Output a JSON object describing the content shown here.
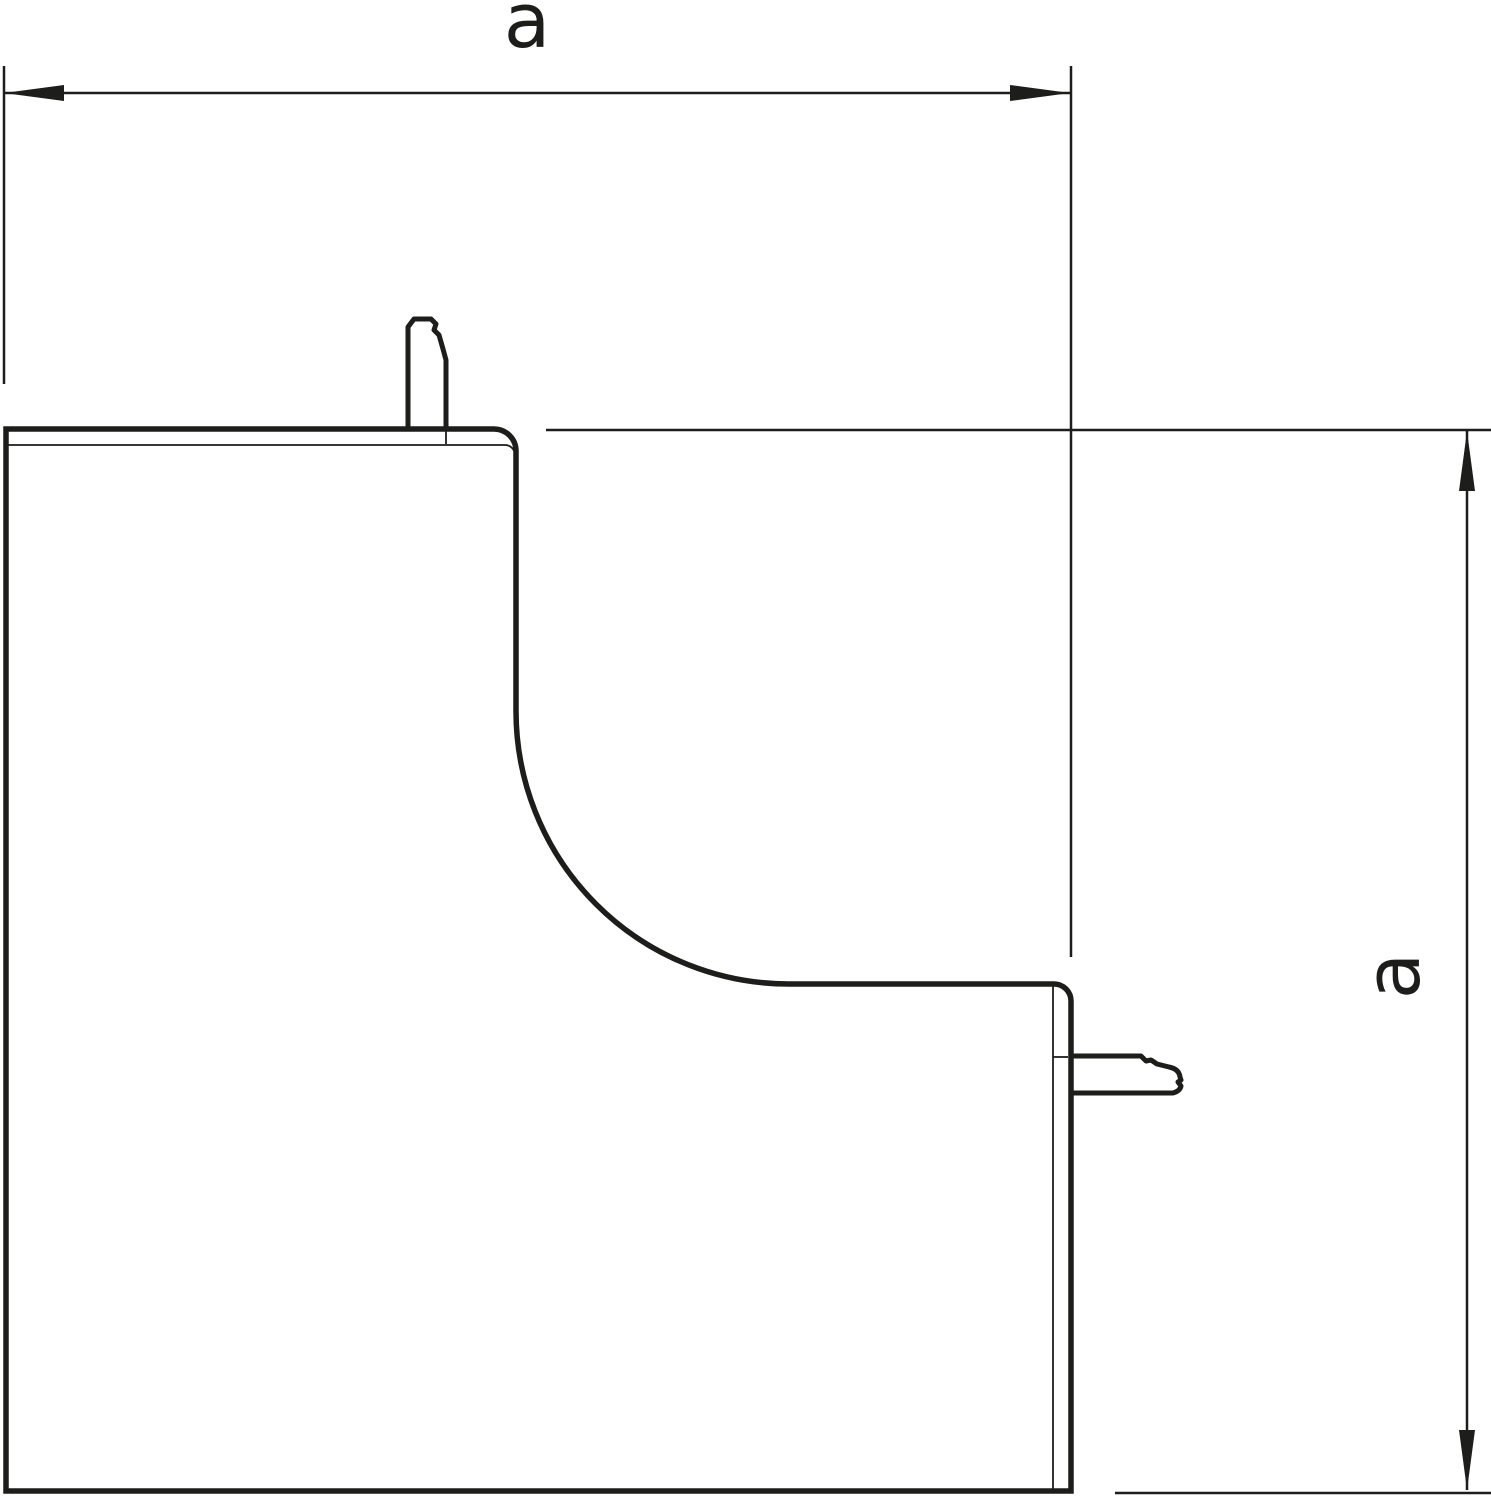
{
  "dimensions": {
    "horizontal_label": "a",
    "vertical_label": "a"
  },
  "colors": {
    "line": "#1d1d1b",
    "background": "#ffffff"
  }
}
